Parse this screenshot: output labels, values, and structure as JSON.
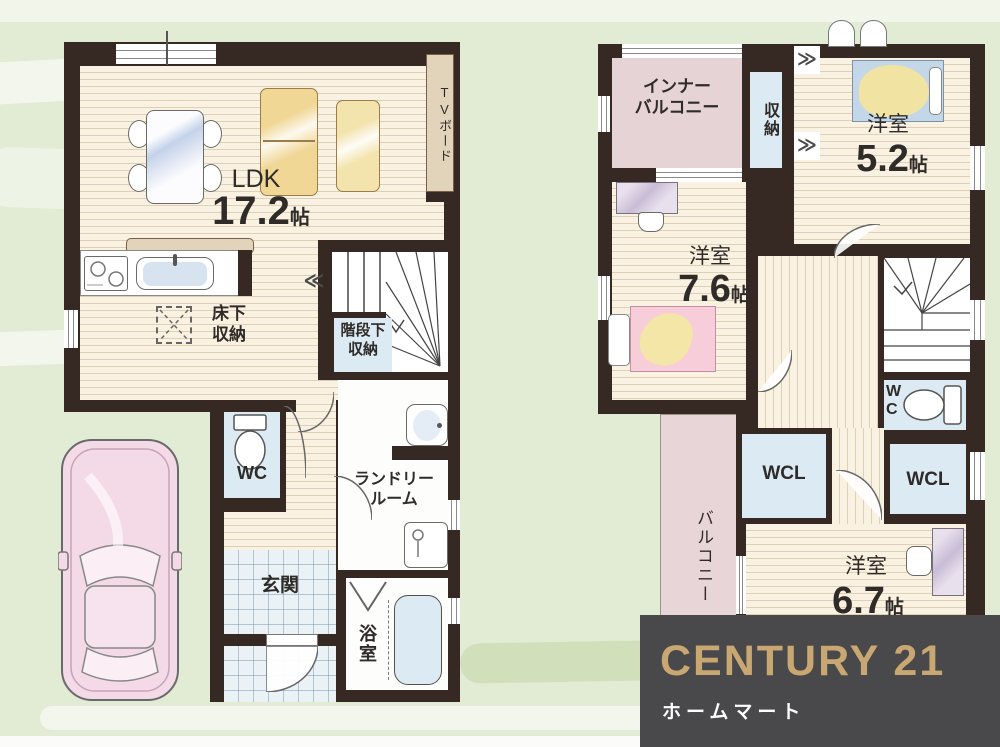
{
  "palette": {
    "background": "#e2ebd4",
    "wall": "#362823",
    "wood_floor": "#f9f1e1",
    "blue_room": "#dceaf4",
    "tile": "#ebf2f6",
    "balcony_pink": "#e7d5d8",
    "logo_background": "#49484a",
    "logo_gold": "#c8a772"
  },
  "floor1": {
    "ldk": {
      "label": "LDK",
      "size_value": "17.2",
      "size_unit": "帖"
    },
    "tv_board": "TVボード",
    "floor_storage": [
      "床下",
      "収納"
    ],
    "stair_storage": [
      "階段下",
      "収納"
    ],
    "wc": "WC",
    "laundry": [
      "ランドリー",
      "ルーム"
    ],
    "entrance": "玄関",
    "bathroom": "浴室"
  },
  "floor2": {
    "inner_balcony": [
      "インナー",
      "バルコニー"
    ],
    "closet": "収納",
    "bedroom_52": {
      "label": "洋室",
      "size_value": "5.2",
      "size_unit": "帖"
    },
    "bedroom_76": {
      "label": "洋室",
      "size_value": "7.6",
      "size_unit": "帖"
    },
    "bedroom_67": {
      "label": "洋室",
      "size_value": "6.7",
      "size_unit": "帖"
    },
    "wc": "WC",
    "wcl_left": "WCL",
    "wcl_right": "WCL",
    "balcony": "バルコニー"
  },
  "logo": {
    "brand": "CENTURY 21",
    "subtitle": "ホームマート"
  }
}
